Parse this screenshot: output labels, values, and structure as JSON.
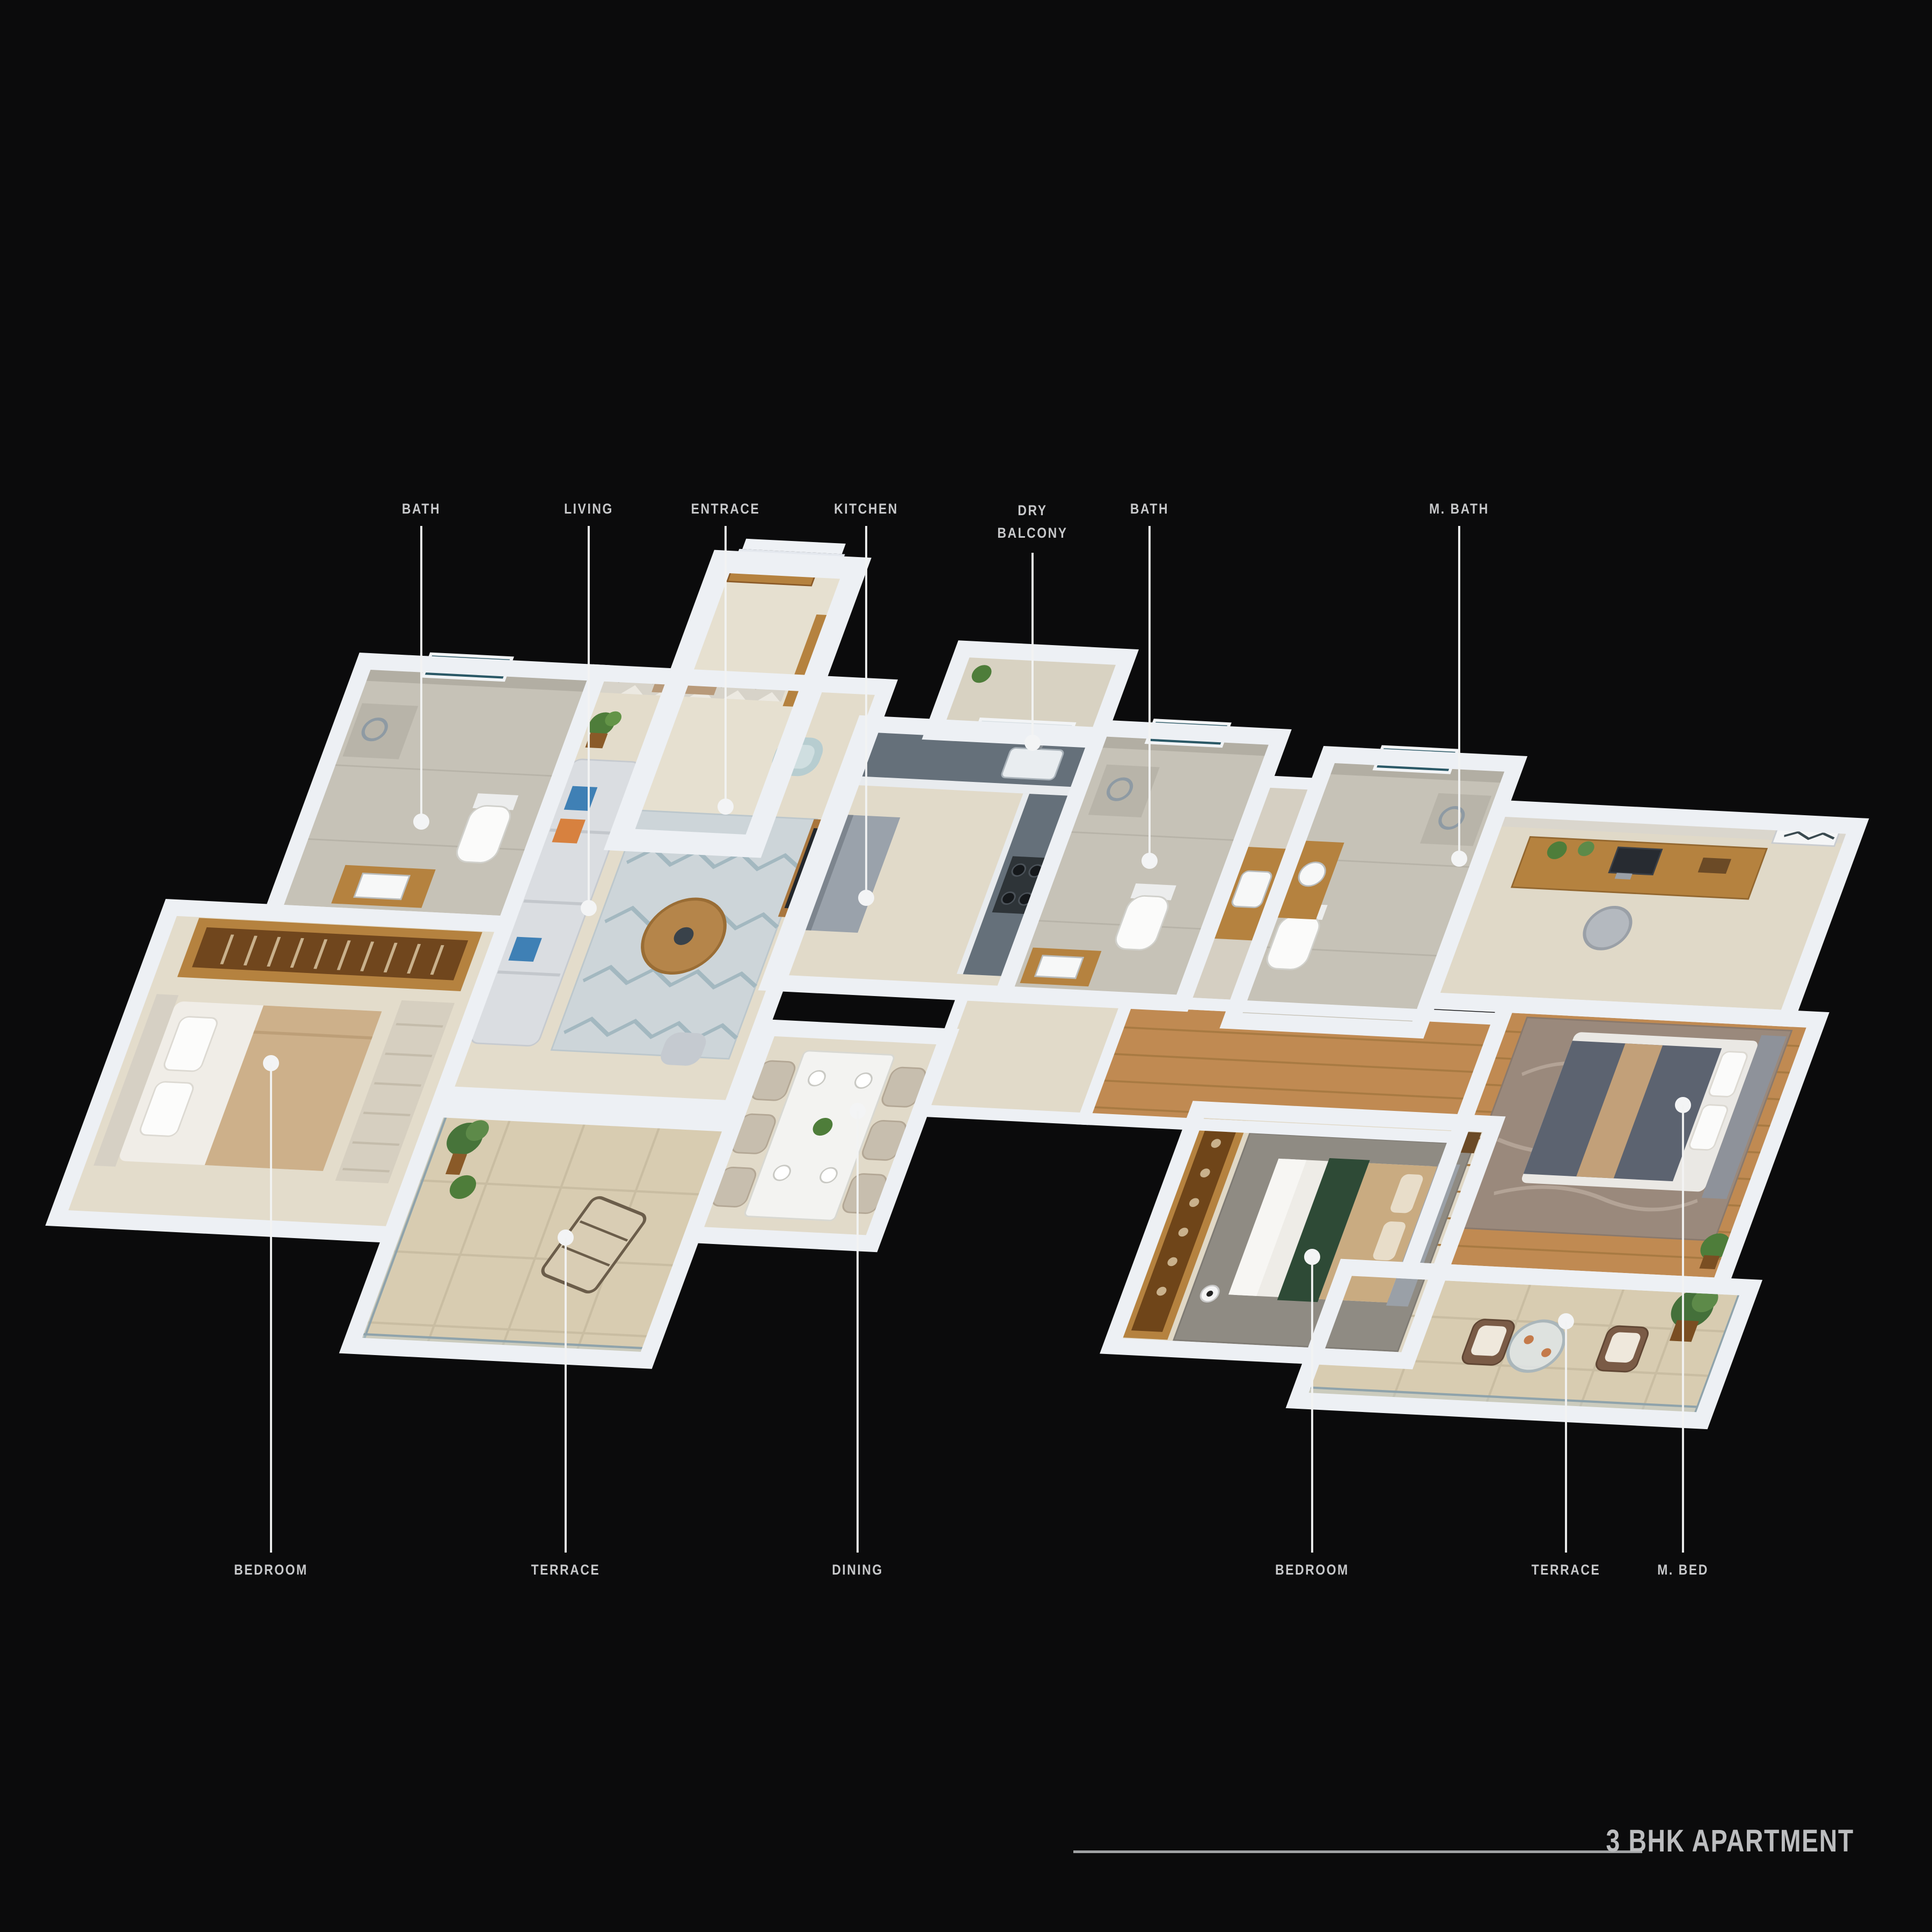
{
  "title": {
    "text": "3 BHK APARTMENT"
  },
  "callouts": {
    "top": [
      {
        "label": "BATH"
      },
      {
        "label": "LIVING"
      },
      {
        "label": "ENTRACE"
      },
      {
        "label": "KITCHEN"
      },
      {
        "label": "DRY BALCONY"
      },
      {
        "label": "BATH"
      },
      {
        "label": "M. BATH"
      }
    ],
    "bottom": [
      {
        "label": "BEDROOM"
      },
      {
        "label": "TERRACE"
      },
      {
        "label": "DINING"
      },
      {
        "label": "BEDROOM"
      },
      {
        "label": "TERRACE"
      },
      {
        "label": "M. BED"
      }
    ]
  },
  "rooms": [
    {
      "name": "Bath",
      "finish": "gray tile"
    },
    {
      "name": "Living",
      "finish": "beige tile"
    },
    {
      "name": "Entrace",
      "finish": "beige tile"
    },
    {
      "name": "Kitchen",
      "finish": "beige tile"
    },
    {
      "name": "Dry Balcony",
      "finish": "beige tile"
    },
    {
      "name": "Bath",
      "finish": "gray tile"
    },
    {
      "name": "M. Bath",
      "finish": "gray tile"
    },
    {
      "name": "Bedroom",
      "finish": "beige tile"
    },
    {
      "name": "Terrace",
      "finish": "beige pavers"
    },
    {
      "name": "Dining",
      "finish": "beige tile"
    },
    {
      "name": "Bedroom",
      "finish": "beige tile"
    },
    {
      "name": "Terrace",
      "finish": "beige pavers"
    },
    {
      "name": "M. Bed",
      "finish": "wood"
    }
  ],
  "colors": {
    "background": "#0b0b0c",
    "label": "#c7c8ca",
    "leader_line": "#f1f2f3",
    "title": "#bcbdbf",
    "wall": "#edf0f4",
    "floor_beige": "#e3dccb",
    "tile_gray": "#c6c2b7",
    "terrace_tile": "#d8ccb1",
    "wood_floor": "#c08a52",
    "furniture_wood": "#b5823f",
    "sofa": "#dadde1",
    "pillow_blue": "#3f80b5",
    "pillow_orange": "#d7813f",
    "bed_green": "#2e4a36",
    "master_duvet": "#5c6370",
    "kitchen_counter": "#65707a",
    "window_teal": "#2a5866"
  }
}
